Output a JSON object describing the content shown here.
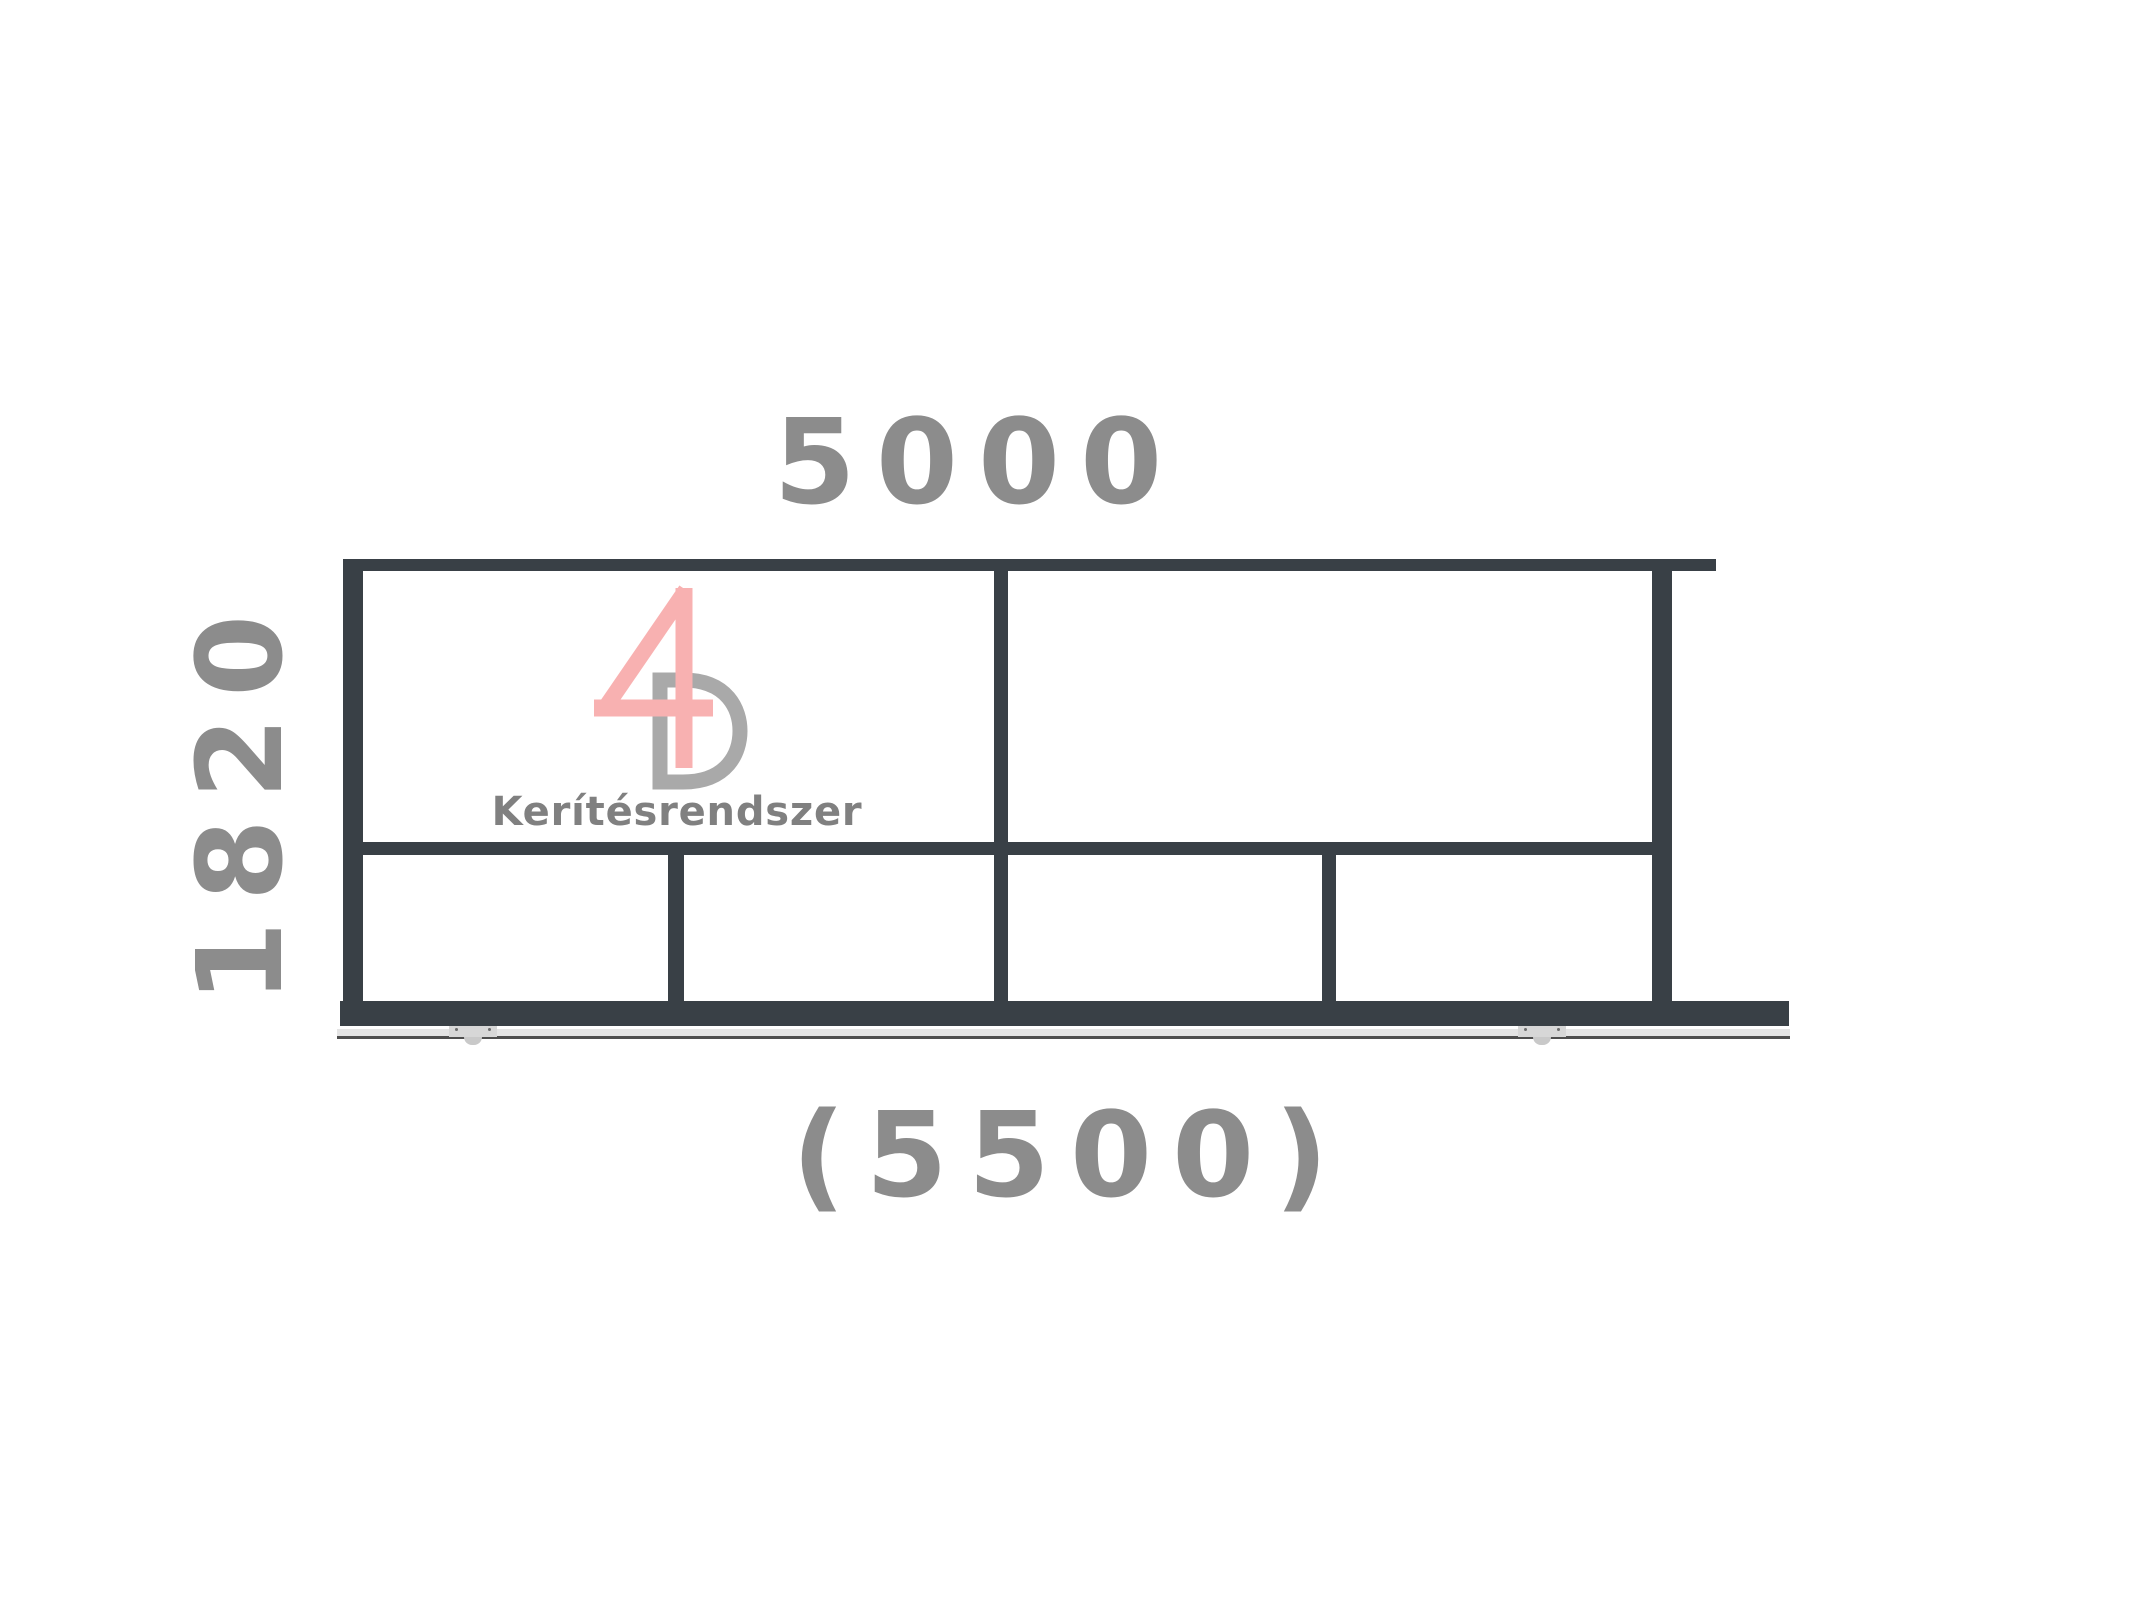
{
  "drawing": {
    "type": "sliding-gate-elevation",
    "labels": {
      "gate_width": "5000",
      "gate_height": "1820",
      "overall_length": "(5500)"
    },
    "logo": {
      "mark": "4D",
      "subtitle": "Kerítésrendszer"
    },
    "colors": {
      "frame": "#394046",
      "dimension_text": "#8c8c8c",
      "logo_pink": "#f8b1b1",
      "logo_gray": "#a9a9a9",
      "logo_text": "#808080",
      "track_band": "#e4e4e4",
      "track_line": "#4e4e4e",
      "roller": "#d7d7d7"
    }
  }
}
